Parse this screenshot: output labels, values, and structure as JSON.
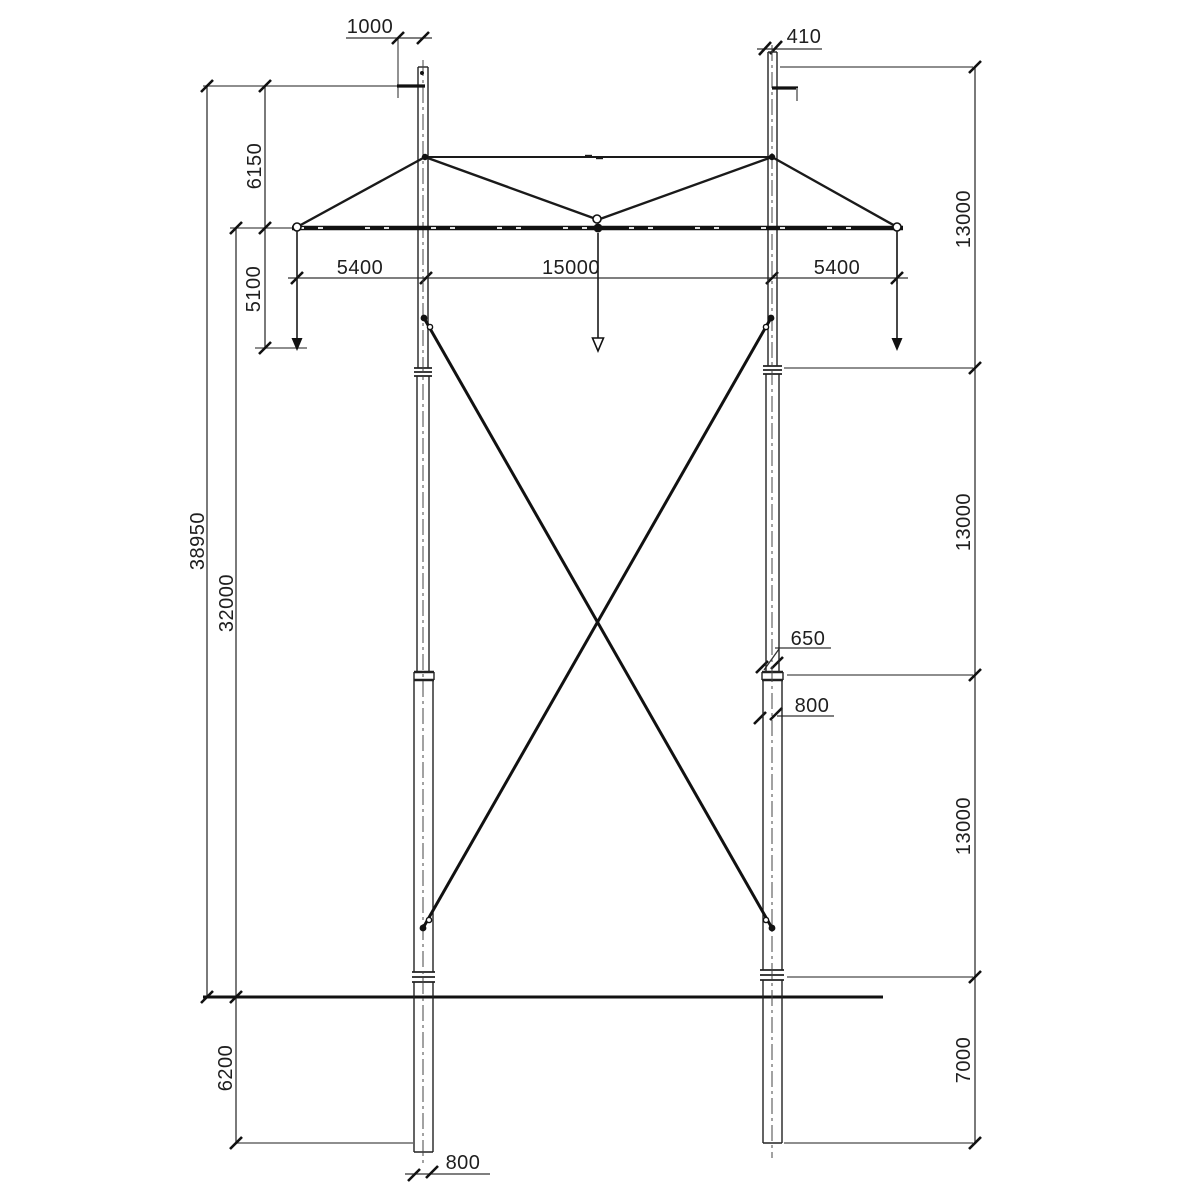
{
  "drawing": {
    "type": "transmission-pole-elevation",
    "units": "mm"
  },
  "colors": {
    "line": "#1a1a1a",
    "thin_line": "#4a4a4a",
    "background": "#ffffff"
  },
  "dimension_labels": {
    "ground_wire_peak_offset": "1000",
    "right_pole_top_width": "410",
    "peak_to_crossarm_height": "6150",
    "insulator_string_drop": "5100",
    "left_crossarm_overhang": "5400",
    "pole_spacing": "15000",
    "right_crossarm_overhang": "5400",
    "right_section_upper": "13000",
    "right_section_middle": "13000",
    "right_section_lower": "13000",
    "right_section_base": "7000",
    "total_height_above_ground": "38950",
    "crossarm_height_above_ground": "32000",
    "joint_upper_diameter": "650",
    "joint_lower_diameter": "800",
    "embedment_depth": "6200",
    "pole_base_diameter": "800"
  }
}
